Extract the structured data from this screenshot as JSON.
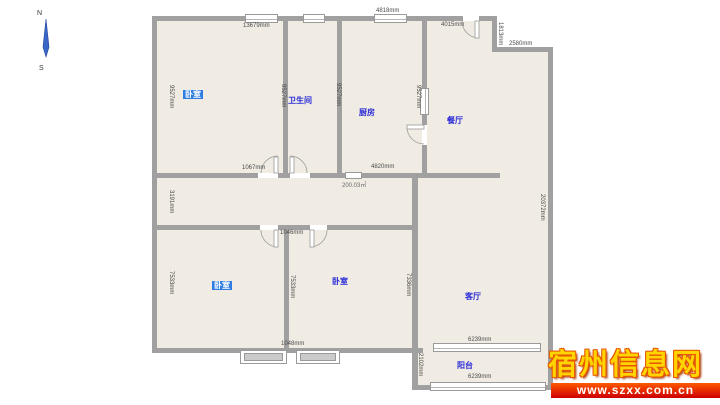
{
  "compass": {
    "north": "N",
    "south": "S"
  },
  "rooms": {
    "bedroom_top": {
      "label": "卧室",
      "selected": true
    },
    "bathroom": {
      "label": "卫生间"
    },
    "kitchen": {
      "label": "厨房"
    },
    "dining": {
      "label": "餐厅"
    },
    "bedroom_left": {
      "label": "卧室",
      "selected": true
    },
    "bedroom_right": {
      "label": "卧室"
    },
    "living": {
      "label": "客厅"
    },
    "balcony": {
      "label": "阳台"
    }
  },
  "dims": {
    "top_wall": "13679mm",
    "kitchen_top_wall": "4818mm",
    "dining_top_wall": "4015mm",
    "step_height": "1813mm",
    "step_width": "2580mm",
    "bedroom_top_left_wall": "9527mm",
    "bathroom_left_wall": "9527mm",
    "bathroom_right_wall": "9527mm",
    "kitchen_right_wall": "9527mm",
    "bedroom_top_door": "1067mm",
    "kitchen_bottom_wall": "4820mm",
    "total_area": "200.03㎡",
    "hall_left_wall": "3191mm",
    "right_wall": "20372mm",
    "bedroom_doors": "1046mm",
    "bedroom_left_wall": "7533mm",
    "bedroom_mid_wall": "7533mm",
    "bedroom_right_wall": "7336mm",
    "bottom_wall_segment": "1048mm",
    "living_window": "6239mm",
    "balcony_left_wall": "2102mm",
    "balcony_window": "6239mm"
  },
  "watermark": {
    "site_name": "宿州信息网",
    "site_url": "www.szxx.com.cn"
  }
}
